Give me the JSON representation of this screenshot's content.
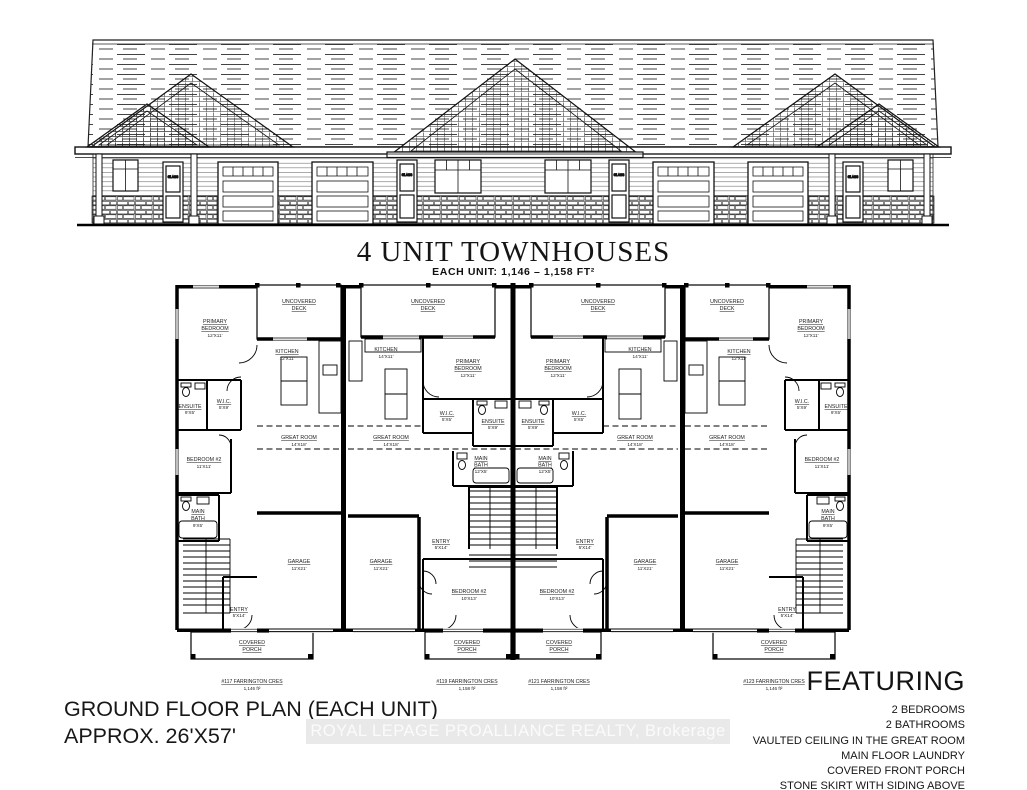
{
  "title": "4 UNIT TOWNHOUSES",
  "subtitle": "EACH UNIT: 1,146  –  1,158 FT²",
  "footer_left": {
    "line1": "GROUND FLOOR PLAN (EACH UNIT)",
    "line2": "APPROX. 26'X57'"
  },
  "watermark": "ROYAL LEPAGE PROALLIANCE REALTY, Brokerage",
  "featuring": {
    "heading": "FEATURING",
    "items": [
      "2 BEDROOMS",
      "2 BATHROOMS",
      "VAULTED CEILING IN THE GREAT ROOM",
      "MAIN FLOOR LAUNDRY",
      "COVERED FRONT PORCH",
      "STONE SKIRT WITH SIDING ABOVE"
    ]
  },
  "elevation": {
    "door_label": "GLASS"
  },
  "plan": {
    "labels": {
      "deck1": "UNCOVERED",
      "deck2": "DECK",
      "porch1": "COVERED",
      "porch2": "PORCH",
      "primary1": "PRIMARY",
      "primary2": "BEDROOM",
      "primary_dim": "12'X11'",
      "kitchen": "KITCHEN",
      "kitchen_dim_end": "12'X11'",
      "kitchen_dim_mid": "14'X11'",
      "ensuite": "ENSUITE",
      "ensuite_dim_end": "9'X5'",
      "ensuite_dim_mid": "5'X9'",
      "wic": "W.I.C.",
      "wic_dim_end": "5'X9'",
      "wic_dim_mid": "5'X5'",
      "great": "GREAT ROOM",
      "great_dim": "14'X18'",
      "bedroom2": "BEDROOM #2",
      "bedroom2_dim_end": "11'X11'",
      "bedroom2_dim_mid": "10'X13'",
      "mainbath1": "MAIN",
      "mainbath2": "BATH",
      "mainbath_dim_end": "9'X5'",
      "mainbath_dim_mid": "12'X5'",
      "garage": "GARAGE",
      "garage_dim": "11'X21'",
      "entry": "ENTRY",
      "entry_dim": "5'X14'"
    },
    "units": [
      {
        "address": "#117 FARRINGTON CRES",
        "area": "1,146 ft²"
      },
      {
        "address": "#119 FARRINGTON CRES",
        "area": "1,158 ft²"
      },
      {
        "address": "#121 FARRINGTON CRES",
        "area": "1,158 ft²"
      },
      {
        "address": "#123 FARRINGTON CRES",
        "area": "1,146 ft²"
      }
    ]
  }
}
